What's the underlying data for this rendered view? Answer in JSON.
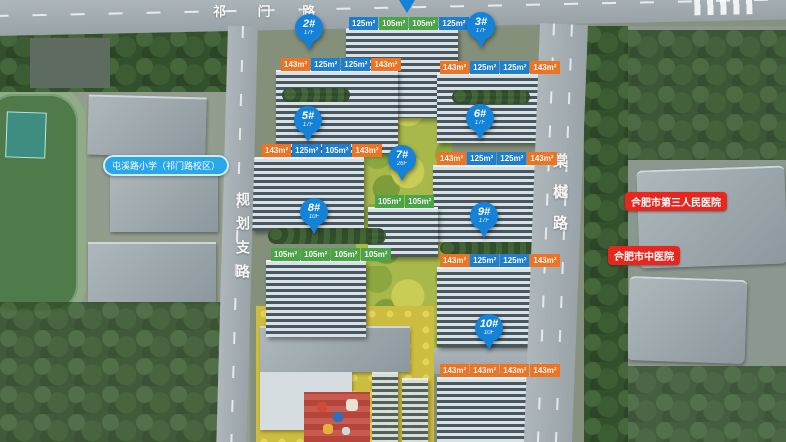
{
  "roads": {
    "top": {
      "name": "祁 门 路"
    },
    "left": {
      "name": "规划支路"
    },
    "right": {
      "name": "棠樾路"
    }
  },
  "landmarks": {
    "school": {
      "label": "屯溪路小学（祁门路校区）",
      "color": "#2aa7e8"
    },
    "hospital_1": {
      "label": "合肥市第三人民医院",
      "color": "#e8261d"
    },
    "hospital_2": {
      "label": "合肥市中医院",
      "color": "#e8261d"
    }
  },
  "colors": {
    "pin_blue": "#1482d8",
    "tag_blue": "#1d7fd0",
    "tag_green": "#4aa547",
    "tag_orange": "#ee7421"
  },
  "buildings": [
    {
      "pin": "",
      "floors": "",
      "tags": [
        {
          "type": "blue",
          "label": "125m²"
        },
        {
          "type": "green",
          "label": "105m²"
        },
        {
          "type": "green",
          "label": "105m²"
        },
        {
          "type": "blue",
          "label": "125m²"
        }
      ]
    },
    {
      "pin": "2#",
      "floors": "17F",
      "tags": [
        {
          "type": "orange",
          "label": "143m²"
        },
        {
          "type": "blue",
          "label": "125m²"
        },
        {
          "type": "blue",
          "label": "125m²"
        },
        {
          "type": "orange",
          "label": "143m²"
        }
      ]
    },
    {
      "pin": "3#",
      "floors": "17F",
      "tags": [
        {
          "type": "orange",
          "label": "143m²"
        },
        {
          "type": "blue",
          "label": "125m²"
        },
        {
          "type": "blue",
          "label": "125m²"
        },
        {
          "type": "orange",
          "label": "143m²"
        }
      ]
    },
    {
      "pin": "5#",
      "floors": "17F",
      "tags": [
        {
          "type": "orange",
          "label": "143m²"
        },
        {
          "type": "blue",
          "label": "125m²"
        },
        {
          "type": "blue",
          "label": "105m²"
        },
        {
          "type": "orange",
          "label": "143m²"
        }
      ]
    },
    {
      "pin": "6#",
      "floors": "17F",
      "tags": [
        {
          "type": "orange",
          "label": "143m²"
        },
        {
          "type": "blue",
          "label": "125m²"
        },
        {
          "type": "blue",
          "label": "125m²"
        },
        {
          "type": "orange",
          "label": "143m²"
        }
      ]
    },
    {
      "pin": "7#",
      "floors": "26F",
      "tags": [
        {
          "type": "green",
          "label": "105m²"
        },
        {
          "type": "green",
          "label": "105m²"
        }
      ]
    },
    {
      "pin": "8#",
      "floors": "10F",
      "tags": [
        {
          "type": "green",
          "label": "105m²"
        },
        {
          "type": "green",
          "label": "105m²"
        },
        {
          "type": "green",
          "label": "105m²"
        },
        {
          "type": "green",
          "label": "105m²"
        }
      ]
    },
    {
      "pin": "9#",
      "floors": "17F",
      "tags": [
        {
          "type": "orange",
          "label": "143m²"
        },
        {
          "type": "blue",
          "label": "125m²"
        },
        {
          "type": "blue",
          "label": "125m²"
        },
        {
          "type": "orange",
          "label": "143m²"
        }
      ]
    },
    {
      "pin": "10#",
      "floors": "10F",
      "tags": [
        {
          "type": "orange",
          "label": "143m²"
        },
        {
          "type": "orange",
          "label": "143m²"
        },
        {
          "type": "orange",
          "label": "143m²"
        },
        {
          "type": "orange",
          "label": "143m²"
        }
      ]
    }
  ]
}
